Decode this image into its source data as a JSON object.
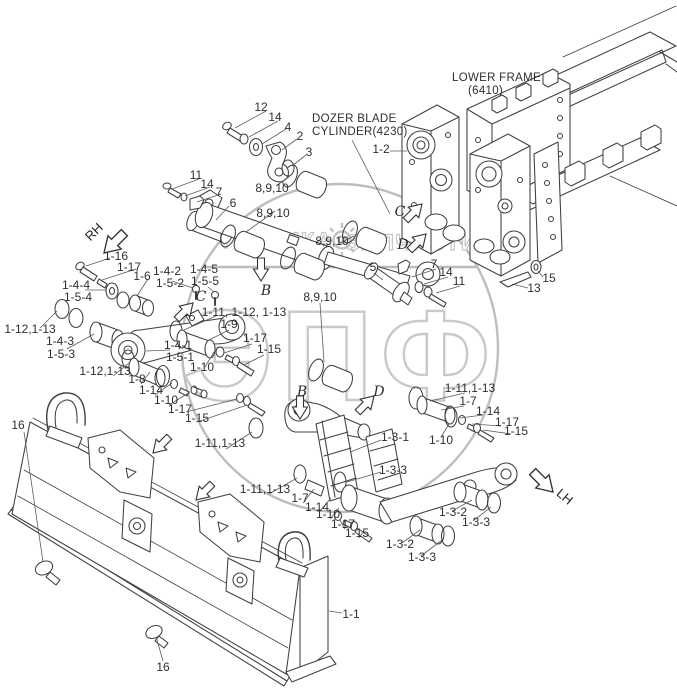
{
  "drawing": {
    "cylinder_label_line1": "DOZER BLADE",
    "cylinder_label_line2": "CYLINDER(4230)",
    "frame_label_line1": "LOWER FRAME",
    "frame_label_line2": "(6410)"
  },
  "view_markers": {
    "b": "B",
    "c": "C",
    "d": "D"
  },
  "direction_markers": {
    "rh": "RH",
    "lh": "LH"
  },
  "watermark": {
    "brand": "ЭПФ",
    "word_left": "ТЕХНИКА",
    "word_right": "ЗАПЧАСТИ"
  },
  "callouts": [
    {
      "text": "12"
    },
    {
      "text": "14"
    },
    {
      "text": "4"
    },
    {
      "text": "2"
    },
    {
      "text": "3"
    },
    {
      "text": "11"
    },
    {
      "text": "14"
    },
    {
      "text": "7"
    },
    {
      "text": "6"
    },
    {
      "text": "8,9,10"
    },
    {
      "text": "8,9,10"
    },
    {
      "text": "8,9,10"
    },
    {
      "text": "8,9,10"
    },
    {
      "text": "5"
    },
    {
      "text": "7"
    },
    {
      "text": "14"
    },
    {
      "text": "11"
    },
    {
      "text": "15"
    },
    {
      "text": "13"
    },
    {
      "text": "1-2"
    },
    {
      "text": "1-16"
    },
    {
      "text": "1-17"
    },
    {
      "text": "1-6"
    },
    {
      "text": "1-4-2"
    },
    {
      "text": "1-5-2"
    },
    {
      "text": "1-4-5"
    },
    {
      "text": "1-5-5"
    },
    {
      "text": "1-4-4"
    },
    {
      "text": "1-5-4"
    },
    {
      "text": "1-12,1-13"
    },
    {
      "text": "1-4-3"
    },
    {
      "text": "1-5-3"
    },
    {
      "text": "1-11, 1-12, 1-13"
    },
    {
      "text": "1-9"
    },
    {
      "text": "1-17"
    },
    {
      "text": "1-15"
    },
    {
      "text": "1-4-1"
    },
    {
      "text": "1-5-1"
    },
    {
      "text": "1-10"
    },
    {
      "text": "1-12,1-13"
    },
    {
      "text": "1-8"
    },
    {
      "text": "1-14"
    },
    {
      "text": "1-10"
    },
    {
      "text": "1-17"
    },
    {
      "text": "1-15"
    },
    {
      "text": "16"
    },
    {
      "text": "1-11,1-13"
    },
    {
      "text": "1-11,1-13"
    },
    {
      "text": "1-7"
    },
    {
      "text": "1-14"
    },
    {
      "text": "1-10"
    },
    {
      "text": "1-17"
    },
    {
      "text": "1-15"
    },
    {
      "text": "1-3-1"
    },
    {
      "text": "1-3-3"
    },
    {
      "text": "1-11,1-13"
    },
    {
      "text": "1-7"
    },
    {
      "text": "1-14"
    },
    {
      "text": "1-17"
    },
    {
      "text": "1-15"
    },
    {
      "text": "1-10"
    },
    {
      "text": "1-3-2"
    },
    {
      "text": "1-3-3"
    },
    {
      "text": "1-3-2"
    },
    {
      "text": "1-3-3"
    },
    {
      "text": "16"
    },
    {
      "text": "1-1"
    }
  ]
}
